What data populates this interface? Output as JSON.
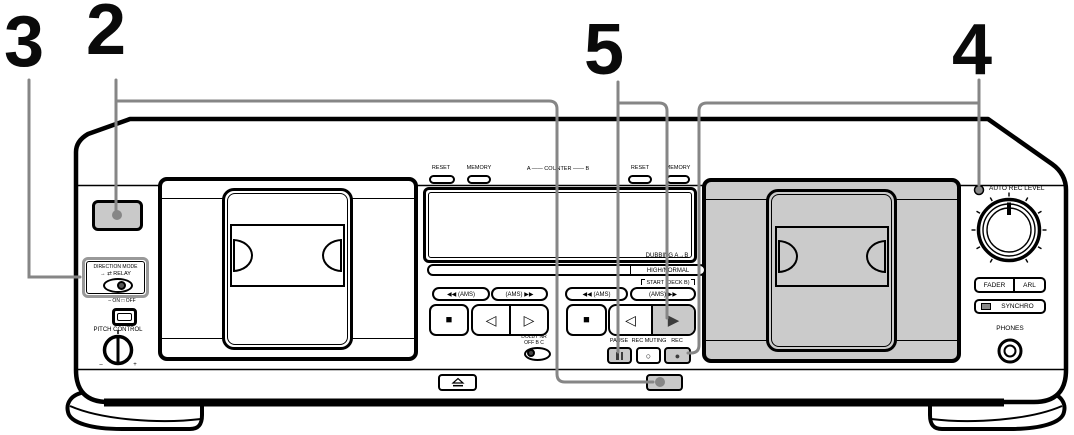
{
  "callouts": {
    "s3": "3",
    "s2": "2",
    "s5": "5",
    "s4": "4"
  },
  "direction_mode": {
    "title": "DIRECTION MODE",
    "modes": "→  ⇄ RELAY"
  },
  "pitch": {
    "onoff": "– ON  □ OFF",
    "label": "PITCH CONTROL",
    "minus": "–",
    "plus": "+"
  },
  "counter": {
    "reset_a": "RESET",
    "memory_a": "MEMORY",
    "label": "A —— COUNTER —— B",
    "reset_b": "RESET",
    "memory_b": "MEMORY"
  },
  "dubbing": {
    "label": "DUBBING A→B",
    "speed": "HIGH/NORMAL",
    "start": "START (DECK B)"
  },
  "deck_a": {
    "ams_left": "◀◀ (AMS)",
    "ams_right": "(AMS) ▶▶",
    "stop": "■",
    "play_rev": "◁",
    "play_fwd": "▷"
  },
  "deck_b": {
    "ams_left": "◀◀ (AMS)",
    "ams_right": "(AMS) ▶▶",
    "stop": "■",
    "play_rev": "◁",
    "play_fwd": "▶"
  },
  "dolby": {
    "title": "DOLBY NR",
    "options": "OFF  B  C"
  },
  "record_row": {
    "pause": "PAUSE",
    "muting": "REC MUTING",
    "rec": "REC",
    "muting_glyph": "○",
    "rec_glyph": "●"
  },
  "right_panel": {
    "auto_rec_level": "AUTO REC LEVEL",
    "fader": "FADER",
    "arl": "ARL",
    "synchro": "SYNCHRO",
    "phones": "PHONES"
  },
  "colors": {
    "highlight": "#c9c9c9",
    "callout": "#868686",
    "door_shade": "#cbcbcb",
    "line": "#000000"
  }
}
